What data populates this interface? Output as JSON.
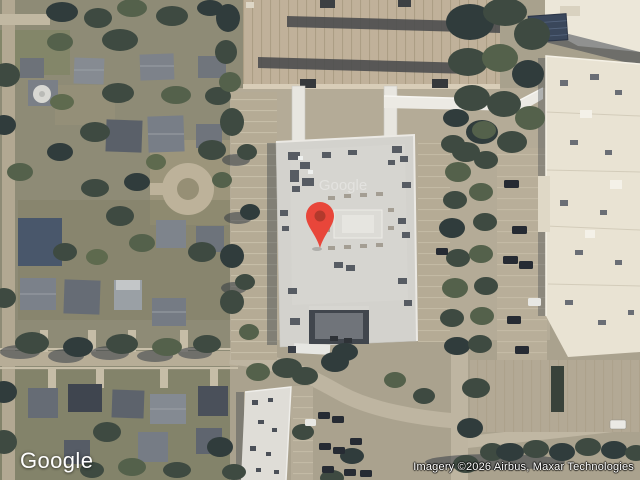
{
  "map": {
    "view_type": "satellite",
    "watermark": "Google",
    "marker": {
      "name": "location-pin",
      "color": "#E8463A",
      "inner_color": "#B2392C",
      "position": {
        "x": 320,
        "y": 247
      }
    },
    "colors": {
      "tree_dark": "#3E4A41",
      "building_roof": "#D3D2CD",
      "right_building": "#E9E3D3",
      "garage_deck": "#C0B19A",
      "pavement": "#B5AB95"
    }
  },
  "footer": {
    "logo": "Google",
    "attribution": "Imagery ©2026 Airbus, Maxar Technologies"
  }
}
